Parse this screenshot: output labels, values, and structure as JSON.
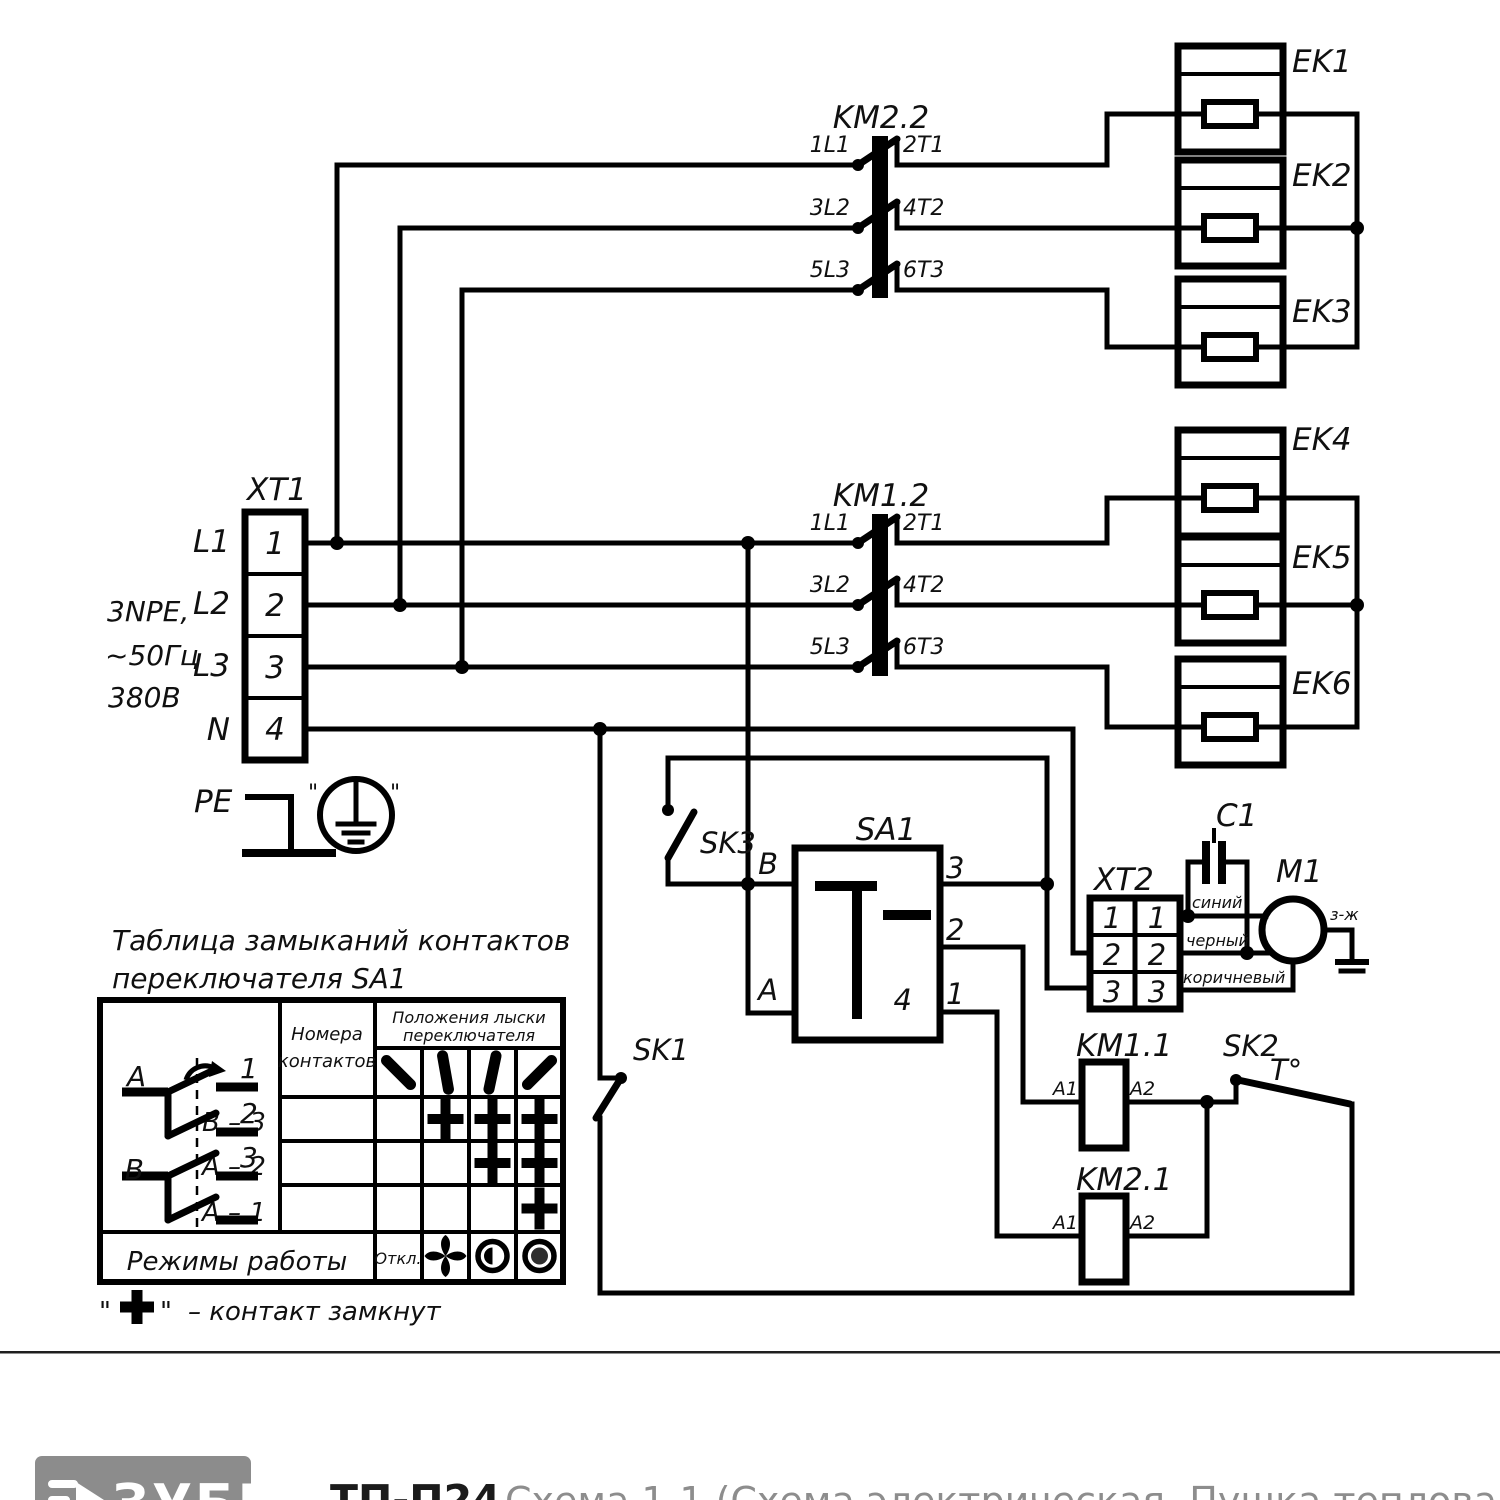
{
  "schematic": {
    "supply": {
      "l1": "3NPE,",
      "l2": "~50Гц",
      "l3": "380В"
    },
    "xt1": {
      "label": "XT1",
      "w1": "L1",
      "w2": "L2",
      "w3": "L3",
      "w4": "N",
      "t1": "1",
      "t2": "2",
      "t3": "3",
      "t4": "4",
      "pe": "PE"
    },
    "km22": {
      "label": "KM2.2",
      "r1in": "1L1",
      "r1out": "2T1",
      "r2in": "3L2",
      "r2out": "4T2",
      "r3in": "5L3",
      "r3out": "6T3"
    },
    "km12": {
      "label": "KM1.2",
      "r1in": "1L1",
      "r1out": "2T1",
      "r2in": "3L2",
      "r2out": "4T2",
      "r3in": "5L3",
      "r3out": "6T3"
    },
    "heaters": {
      "ek1": "EK1",
      "ek2": "EK2",
      "ek3": "EK3",
      "ek4": "EK4",
      "ek5": "EK5",
      "ek6": "EK6"
    },
    "sa1": {
      "label": "SA1",
      "b": "B",
      "a": "A",
      "p1": "1",
      "p2": "2",
      "p3": "3",
      "p4": "4"
    },
    "sk1": {
      "label": "SK1"
    },
    "sk2": {
      "label": "SK2",
      "temp": "T°"
    },
    "sk3": {
      "label": "SK3"
    },
    "xt2": {
      "label": "XT2",
      "l1": "1",
      "l2": "2",
      "l3": "3",
      "r1": "1",
      "r2": "2",
      "r3": "3"
    },
    "c1": {
      "label": "C1"
    },
    "m1": {
      "label": "M1",
      "ground": "з-ж"
    },
    "wires": {
      "blue": "синий",
      "black": "черный",
      "brown": "коричневый"
    },
    "km11": {
      "label": "KM1.1",
      "a1": "A1",
      "a2": "A2"
    },
    "km21": {
      "label": "KM2.1",
      "a1": "A1",
      "a2": "A2"
    }
  },
  "table": {
    "title1": "Таблица замыканий контактов",
    "title2": "переключателя SA1",
    "head_contacts1": "Номера",
    "head_contacts2": "контактов",
    "head_positions1": "Положения лыски",
    "head_positions2": "переключателя",
    "diagram": {
      "a": "A",
      "b": "B",
      "t1": "1",
      "t2": "2",
      "t3": "3"
    },
    "row1": "В – 3",
    "row2": "А – 2",
    "row3": "А – 1",
    "cross_matrix": [
      [
        0,
        1,
        1,
        1
      ],
      [
        0,
        0,
        1,
        1
      ],
      [
        0,
        0,
        0,
        1
      ]
    ],
    "position_angles_deg": [
      -45,
      -10,
      12,
      45
    ],
    "modes_label": "Режимы работы",
    "mode_off": "Откл."
  },
  "legend": {
    "quote": "\"",
    "plus_meaning": "– контакт замкнут"
  },
  "footer": {
    "brand": "ЗУБР",
    "model": "ТП-П24.",
    "caption": "Схема 1-1 (Схема электрическая. Пушка тепловая)"
  }
}
